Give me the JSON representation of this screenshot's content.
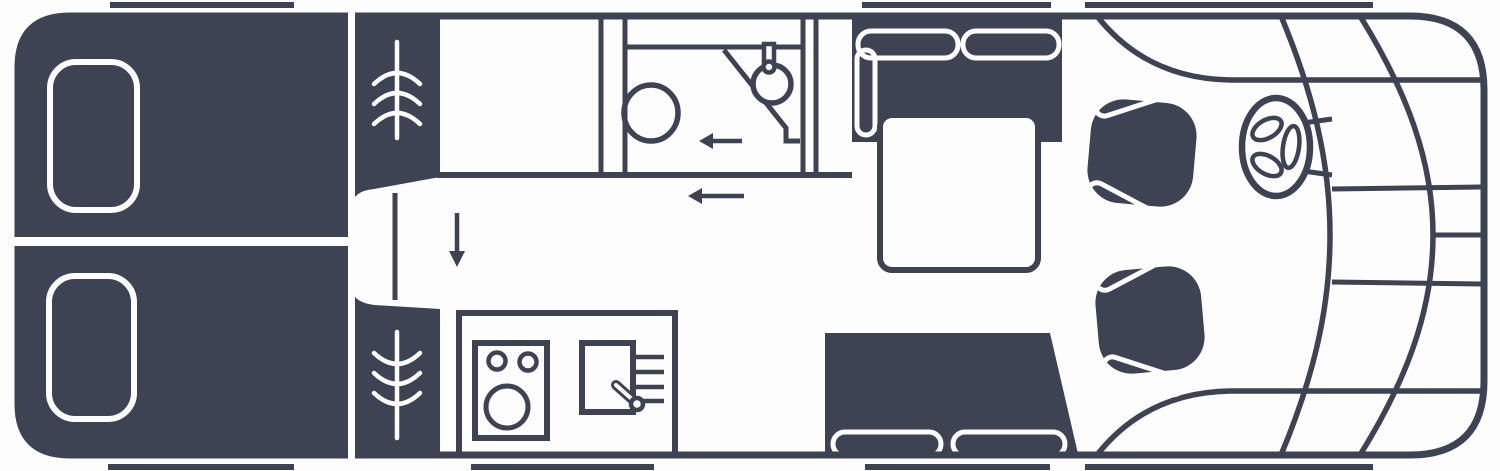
{
  "meta": {
    "title": "Motorhome floor plan, top view, cab on the right",
    "diagram_type": "vehicle-floorplan"
  },
  "colors": {
    "ink": "#3e4353",
    "paper": "#fdfdfd"
  },
  "legend": {
    "rear_bedroom": "twin-single-beds-with-pillows",
    "wardrobe": "wardrobe-column-with-vent-symbols",
    "walkway": "step-between-beds",
    "washroom": "toilet-corner-basin-with-tap",
    "kitchen": "two-burner-hob-round-sink-drainer",
    "dinette": "l-shaped-bench-with-table",
    "side_bench": "two-seat-bench-with-cushions",
    "cab": "two-swivel-seats-and-steering-wheel",
    "arrows": "entry-and-walk-direction-markers"
  }
}
